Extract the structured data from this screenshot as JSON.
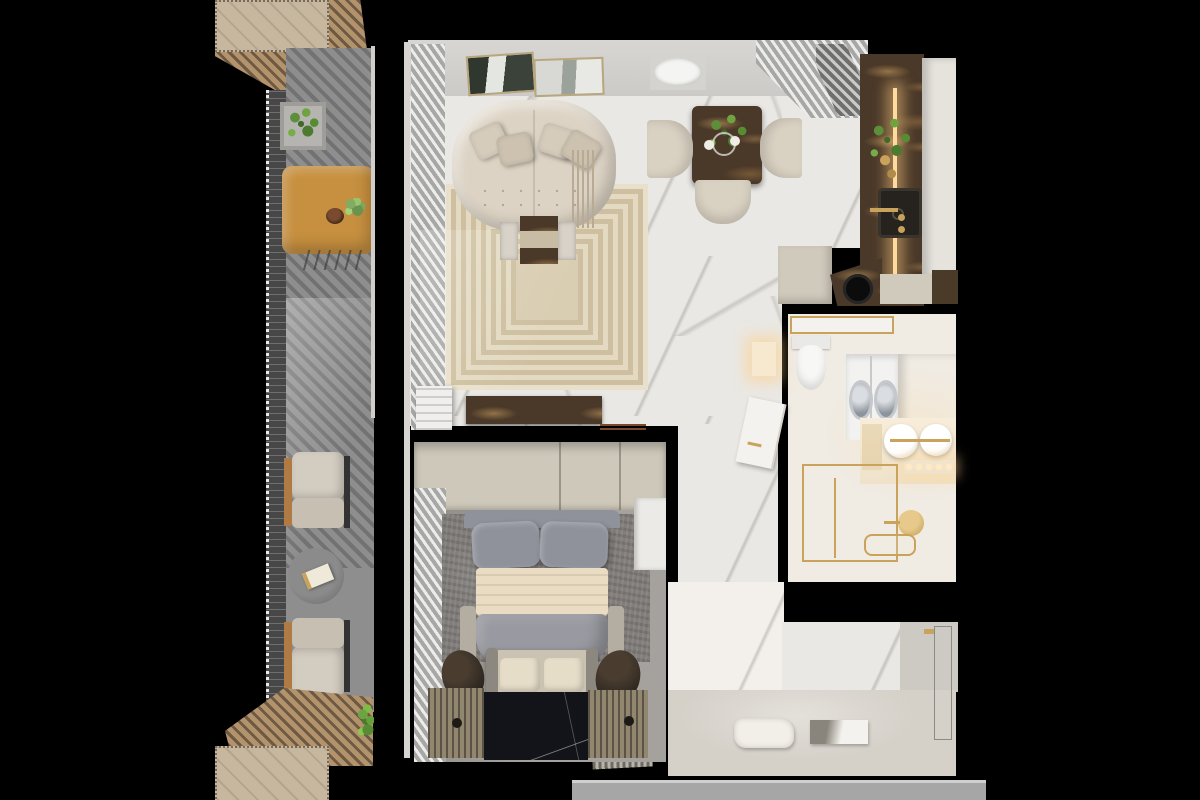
{
  "scene": {
    "type": "3d-floor-plan-render",
    "view": "top-down",
    "width_px": 1200,
    "height_px": 800,
    "style": "modern luxury apartment, white marble with gold and emperador-brown accents"
  },
  "palette": {
    "bg": "#000000",
    "wall_band": "#d8d6d3",
    "marble_floor": "#eae8e4",
    "wood": "#b3936c",
    "wood_dark": "#6e5a42",
    "wood_deck": "#c6b79e",
    "balcony_floor": "#8e8e8e",
    "railing": "#474747",
    "table_wood": "#c79040",
    "curtain_light": "#ececeb",
    "curtain_dark": "#a7a7a5",
    "cream": "#d9d1c2",
    "rug_base": "#d9cdb2",
    "emperador": "#4a3828",
    "cabinet_white": "#e6e3dd",
    "cabinet_beige": "#d0cabc",
    "led": "#ffd9a0",
    "sink_dark": "#26221d",
    "gold": "#c9a35c",
    "bath_floor": "#f0ebe3",
    "sage": "#aab3ad",
    "washer": "#f2f2f1",
    "toilet": "#f7f7f5",
    "wardrobe": "#cec8ba",
    "bed_gray": "#999aa1",
    "pillow_gray": "#8f929b",
    "blanket": "#e9dcc2",
    "bedroom_rug": "#807d7a",
    "black_marble": "#131419",
    "mat": "#91876f",
    "mat_dark": "#5c5346",
    "pouf": "#2a241e",
    "entry_floor": "#d5d0c8",
    "entry_wall": "#cdc9c3",
    "outside": "#a6a6a6",
    "plant": "#5d8f3a",
    "bench": "#cbc3b2",
    "glass_white": "#f4f2ee"
  },
  "rooms": [
    {
      "id": "balcony",
      "furniture": [
        "pergola-deck-top",
        "pergola-deck-bottom",
        "cable-railing",
        "concrete-planter",
        "wood-dining-table",
        "fruit-bowl",
        "flowers",
        "outdoor-armchair-upper",
        "outdoor-armchair-lower",
        "round-side-table",
        "book",
        "plant-sprig"
      ]
    },
    {
      "id": "living-room",
      "furniture": [
        "curved-tufted-sofa",
        "throw-pillows",
        "fringe-throw",
        "concentric-pattern-rug",
        "marble-coffee-table",
        "wall-art-left",
        "wall-art-right",
        "striped-curtains",
        "tv-console-marble",
        "towel-stack",
        "remote-sticks"
      ]
    },
    {
      "id": "dining-area",
      "furniture": [
        "square-marble-table",
        "centerpiece-plant",
        "cups",
        "dining-chair-left",
        "dining-chair-right",
        "dining-chair-bottom",
        "oval-wall-plate",
        "striped-curtains"
      ]
    },
    {
      "id": "kitchen",
      "furniture": [
        "slatted-range-hood",
        "emperador-counter",
        "led-light-strip",
        "tall-white-cabinets",
        "herb-plants",
        "gold-jars",
        "black-sink",
        "gold-faucet",
        "lower-cabinet-left",
        "lower-counter-diagonal",
        "round-cooktop",
        "lower-cabinet-right",
        "dark-wood-cabinet"
      ]
    },
    {
      "id": "bathroom",
      "furniture": [
        "gold-trim-glass-partition",
        "toilet",
        "washer-dryer-pair",
        "sage-storage-cabinet",
        "gold-ornate-panel",
        "double-round-sinks",
        "gold-faucets",
        "vanity-bulb-lights",
        "gold-shower-enclosure",
        "rain-shower-head",
        "gold-caddy",
        "white-door-ajar",
        "lit-niche"
      ]
    },
    {
      "id": "bedroom",
      "furniture": [
        "full-width-wardrobe",
        "white-door-panel",
        "striped-curtains",
        "textured-gray-rug",
        "double-bed",
        "gray-pillows",
        "cream-folded-blanket",
        "gray-duvet",
        "foot-bench-with-cushions",
        "dark-pouf-left",
        "dark-pouf-right",
        "wood-slat-mat-left",
        "wood-slat-mat-right",
        "black-marble-floor"
      ]
    },
    {
      "id": "entry-hall",
      "furniture": [
        "sage-closet-strip",
        "marble-feature-wall",
        "fluffy-white-mat",
        "flat-art-mat",
        "entry-door-outline",
        "gold-door-hardware",
        "striped-doormat",
        "corridor-strip-outside"
      ]
    }
  ]
}
